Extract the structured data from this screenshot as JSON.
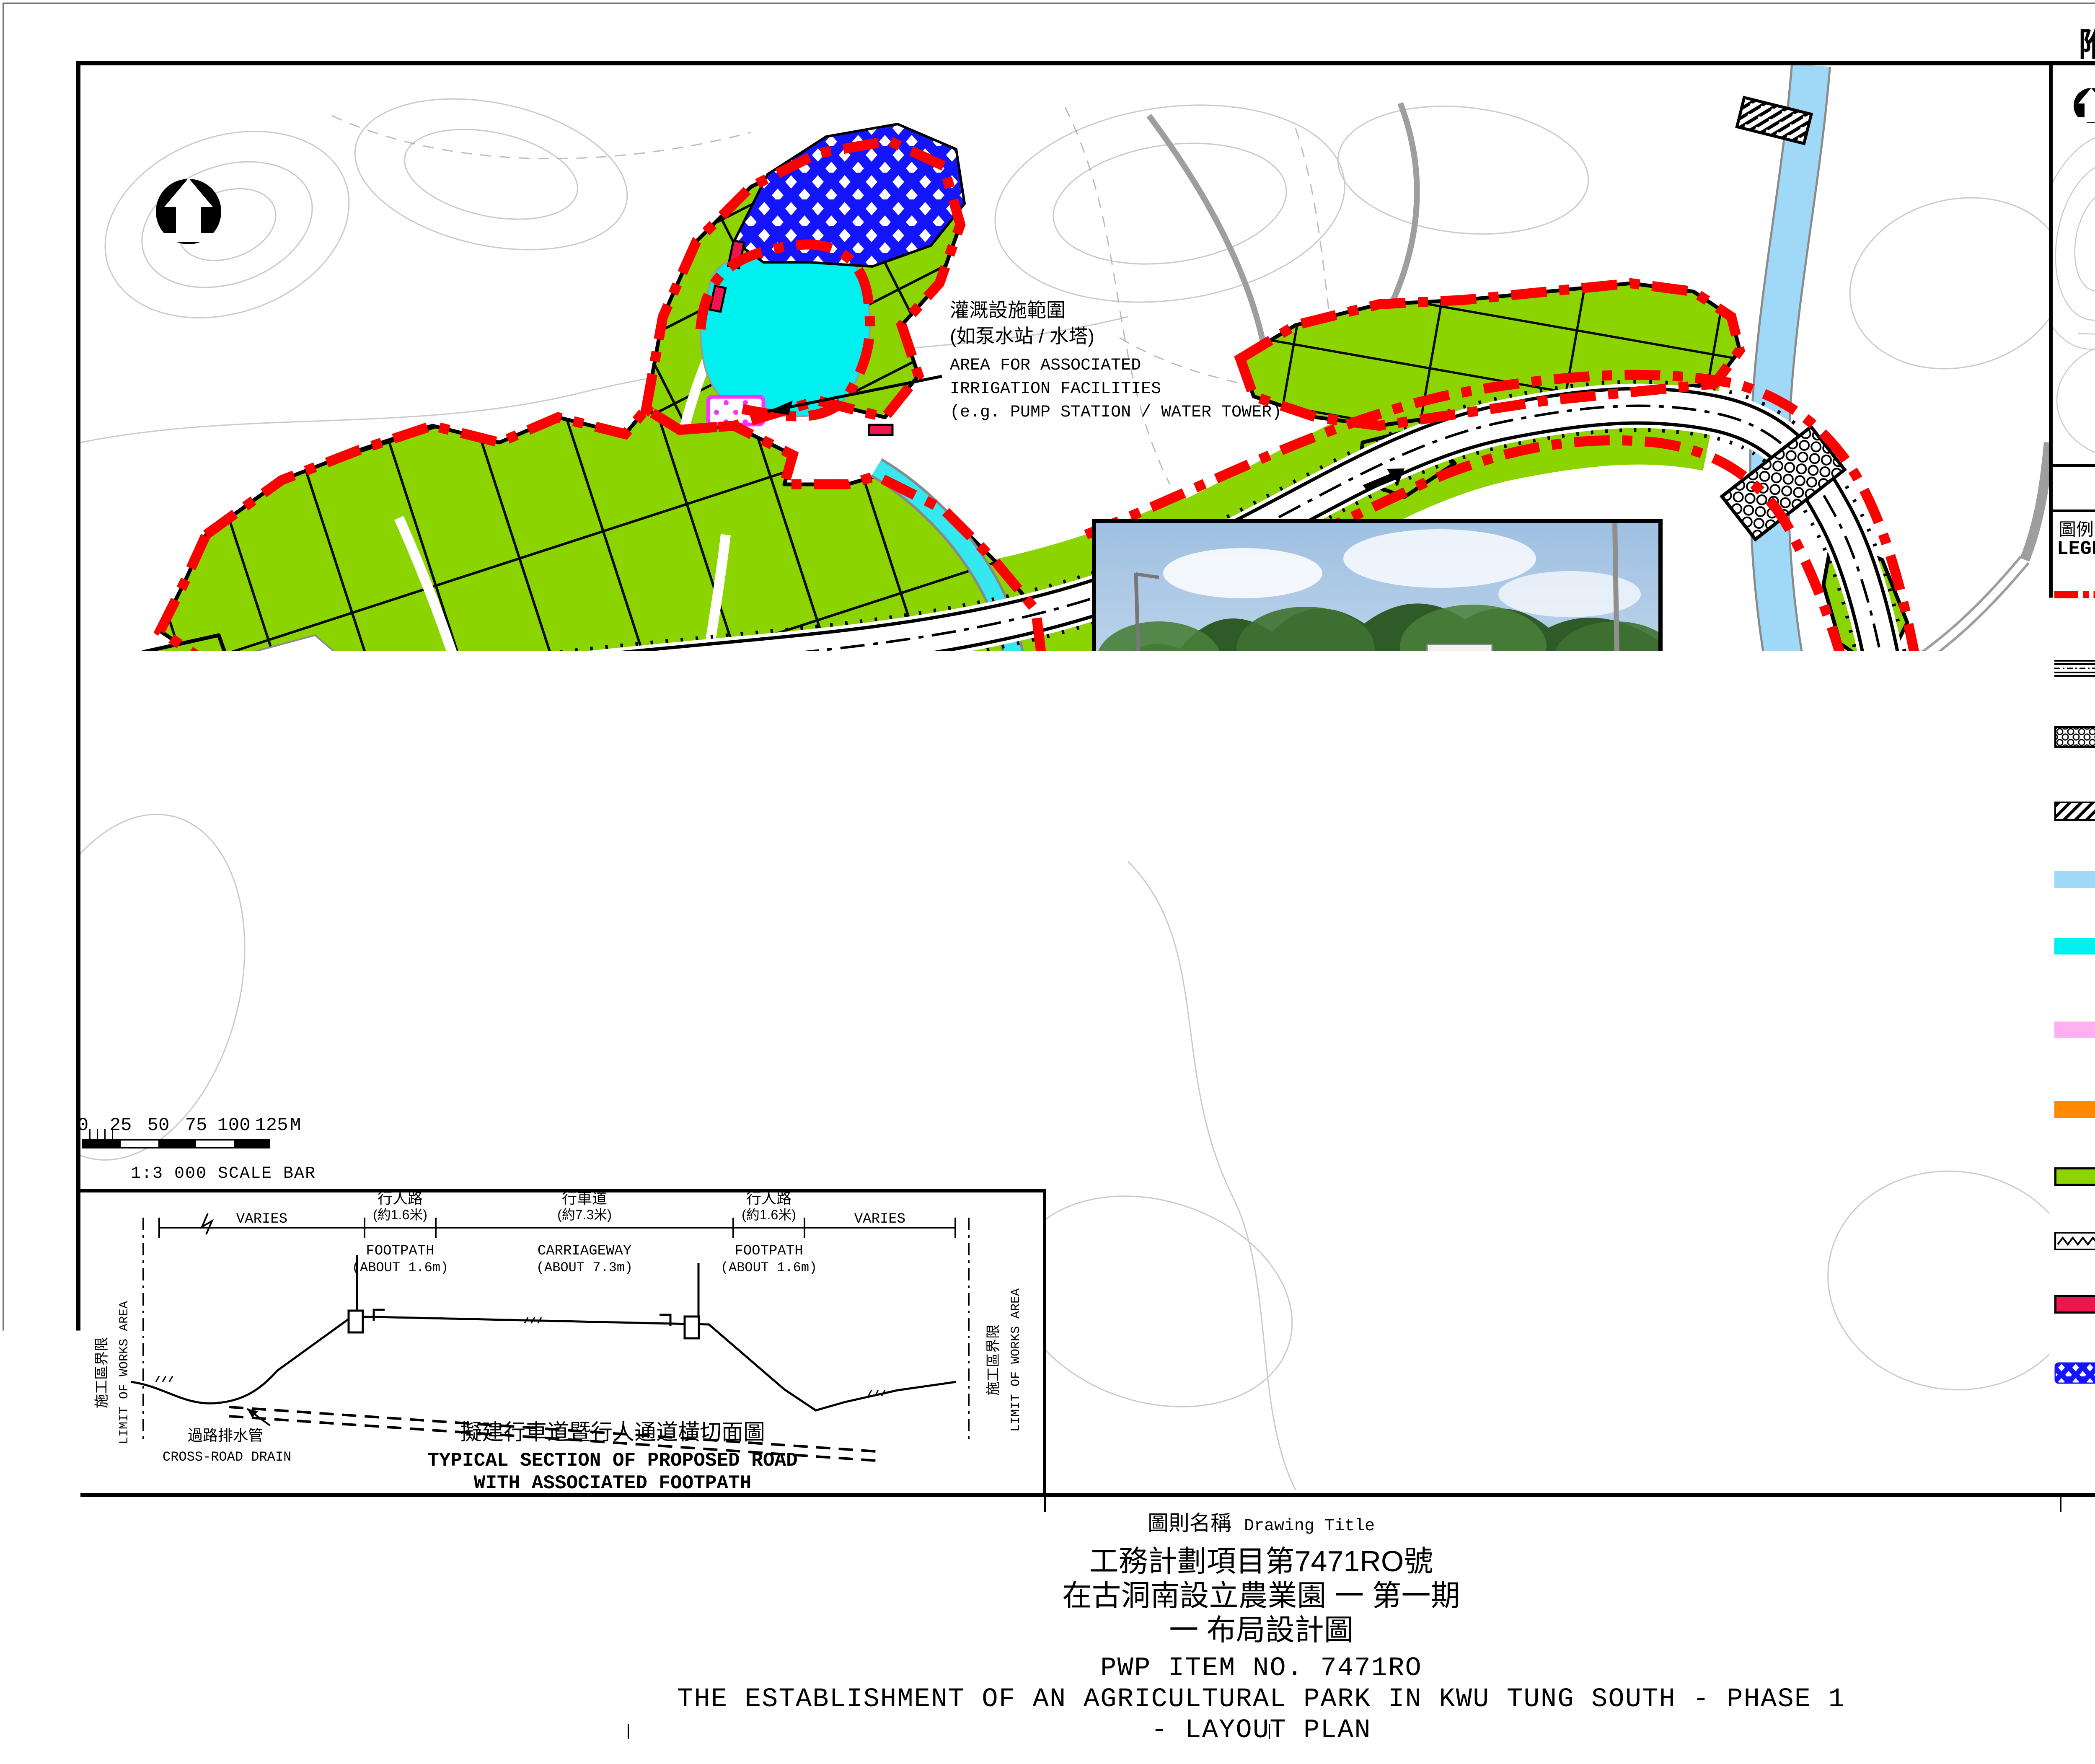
{
  "page": {
    "enclosure": "附件1 ENCLOSURE 1"
  },
  "map": {
    "annotation": {
      "zh1": "灌溉設施範圍",
      "zh2": "(如泵水站 / 水塔)",
      "en1": "AREA FOR ASSOCIATED",
      "en2": "IRRIGATION FACILITIES",
      "en3": "(e.g. PUMP STATION / WATER TOWER)"
    },
    "road_label": "蕉徑路 Tsiu Keng Road",
    "scalebar": {
      "ticks": [
        "0",
        "25",
        "50",
        "75",
        "100",
        "125"
      ],
      "unit": "M",
      "caption": "1:3 000  SCALE BAR"
    }
  },
  "keyplan": {
    "title_zh": "索引圖",
    "title_en": "KEY PLAN",
    "places": [
      {
        "zh": "長瀝",
        "en": "Cheung Lek"
      },
      {
        "zh": "蓮塘尾",
        "en": "Lin Tong Mei"
      },
      {
        "zh": "蕉徑",
        "en": "Tsiu Keng"
      }
    ]
  },
  "legend": {
    "heading_zh": "圖例:",
    "heading_en": "LEGEND:",
    "items": [
      {
        "zh": "農業園第一期擬議範圍",
        "en1": "BOUNDARY OF PROPOSED AGRICULTURAL PARK",
        "en2": "(PHASE 1)"
      },
      {
        "zh": "擬建行車道暨行人通道",
        "en1": "PROPOSED ROAD WITH ASSOCIATED FOOTPATH"
      },
      {
        "zh": "擬建行車橋連行人路",
        "en1": "PROPOSED VEHICULAR BRIDGE WITH FOOTPATH"
      },
      {
        "zh": "擬建暗渠",
        "en1": "PROPOSED CULVERT"
      },
      {
        "zh": "現有河道 / 河流",
        "en1": "EXISTING RIVER / STREAM COURSE"
      },
      {
        "zh": "擬建灌溉用蓄水池",
        "en1": "PROPOSED IRRIGATION STORAGE POND"
      },
      {
        "zh": "現有行人通道 / 小徑 (擴闊至1.6米)",
        "en1": "EXISTING FOOTPATH / TRACK",
        "en2": "(WIDENING TO 1.6m WIDE)"
      },
      {
        "zh": "擬建行人路 (1.5米闊)",
        "en1": "PROPOSED FOOTPATH (1.5m WIDE)"
      },
      {
        "zh": "擬建農田",
        "en1": "PROPOSED FARMLAND"
      },
      {
        "zh": "擬建留宿設施",
        "en1": "PROPOSED LODGING"
      },
      {
        "zh": "擬建農耕貯物設施",
        "en1": "PROPOSED STORAGE"
      },
      {
        "zh": "擬建樹木保存地帶",
        "en1": "PROPOSED TREE PRESERVATION ZONE"
      }
    ]
  },
  "section": {
    "varies_left": "VARIES",
    "varies_right": "VARIES",
    "footpath_zh": "行人路",
    "footpath_zh_dim": "(約1.6米)",
    "footpath_en": "FOOTPATH",
    "footpath_en_dim": "(ABOUT 1.6m)",
    "carriageway_zh": "行車道",
    "carriageway_zh_dim": "(約7.3米)",
    "carriageway_en": "CARRIAGEWAY",
    "carriageway_en_dim": "(ABOUT 7.3m)",
    "low_zh": "施工區界限",
    "low_en": "LIMIT OF WORKS AREA",
    "drain_zh": "過路排水管",
    "drain_en": "CROSS-ROAD DRAIN",
    "caption_zh": "擬建行車道暨行人通道橫切面圖",
    "caption_en1": "TYPICAL SECTION OF PROPOSED ROAD",
    "caption_en2": "WITH ASSOCIATED FOOTPATH"
  },
  "insets": {
    "bridge": {
      "caption_zh": "擬建行車橋連行人路的模擬圖",
      "caption_en1": "PHOTOMONTAGE OF PROPOSED VEHICULAR BRIDGE",
      "caption_en2": "WITH FOOTPATH"
    },
    "aerial": {
      "caption_zh": "農業園第一期模擬圖",
      "caption_en": "AGRICULTURAL PARK PHASE 1 PHOTOMONTAGE"
    }
  },
  "titleblock": {
    "label_zh": "圖則名稱",
    "label_en": "Drawing Title",
    "zh1": "工務計劃項目第7471RO號",
    "zh2": "在古洞南設立農業園 一 第一期",
    "zh3": "一 布局設計圖",
    "en1": "PWP ITEM NO. 7471RO",
    "en2": "THE ESTABLISHMENT OF AN AGRICULTURAL PARK IN KWU TUNG SOUTH - PHASE 1",
    "en3": "- LAYOUT PLAN"
  },
  "colors": {
    "boundary": "#FF0000",
    "farmland": "#8CD400",
    "pond": "#00F0F0",
    "river": "#9FD9F7",
    "tree_zone": "#1414FF",
    "storage": "#F0154F",
    "footpath": "#FF8A00",
    "track": "#FFB0F0"
  }
}
